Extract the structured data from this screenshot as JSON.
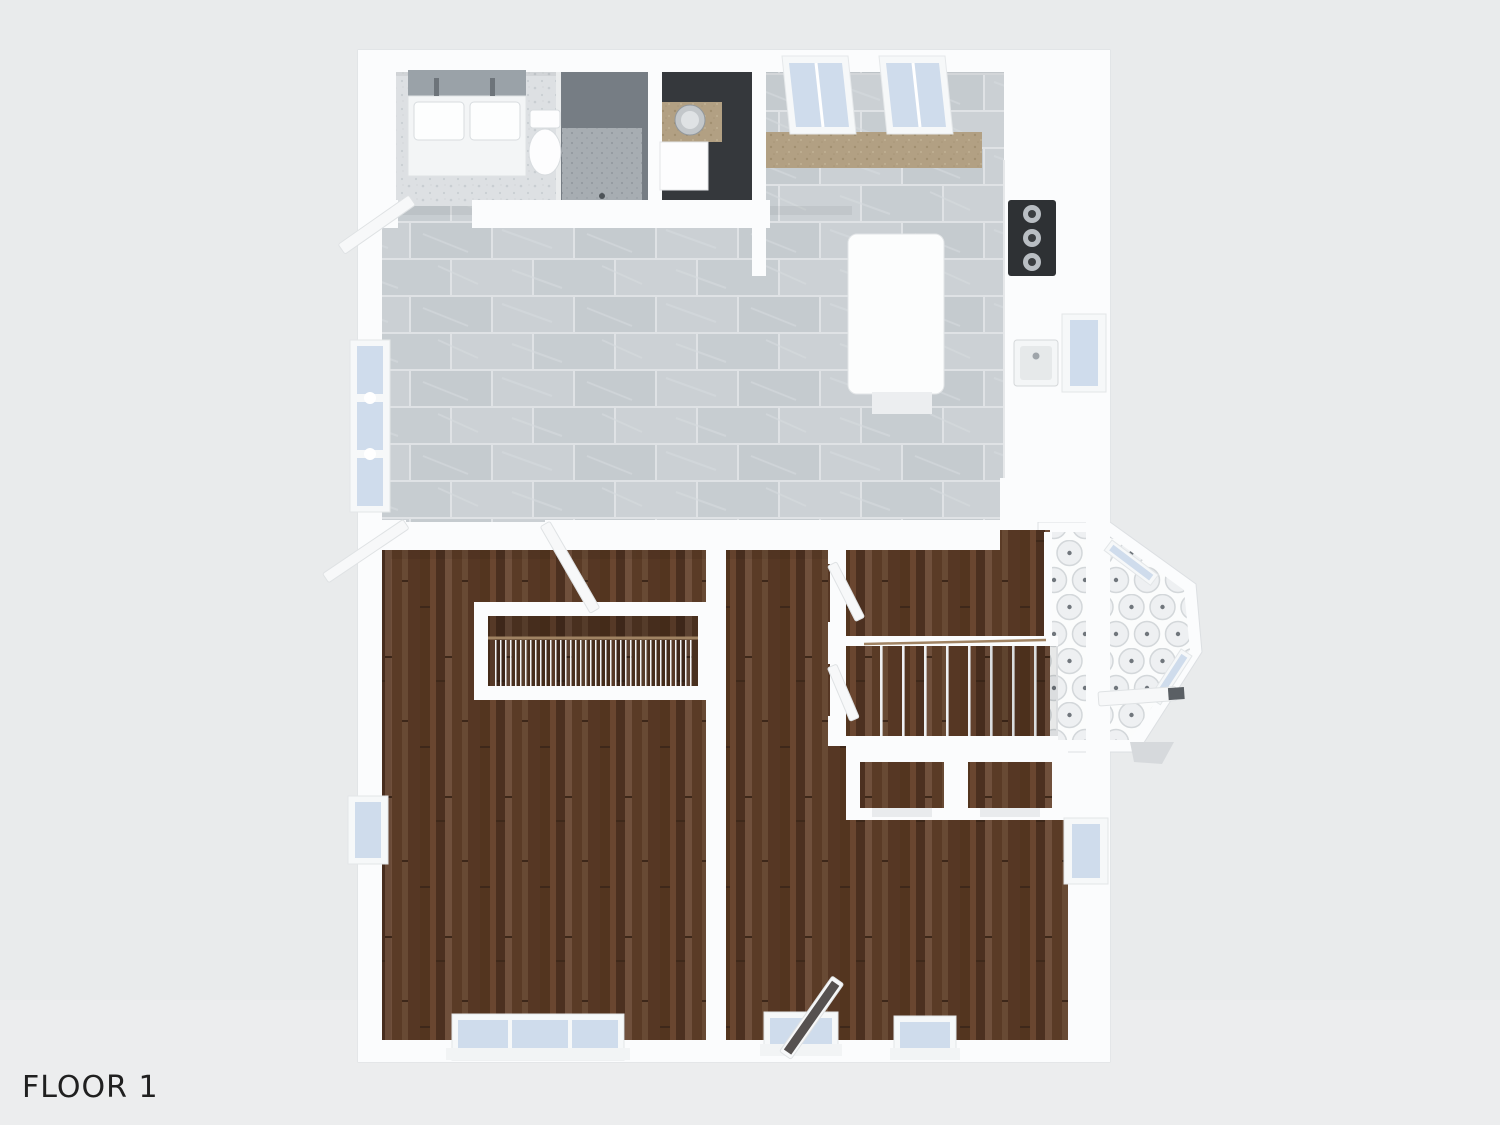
{
  "page": {
    "floor_label": "FLOOR 1"
  },
  "colors": {
    "background": "#e9ebec",
    "wall": "#fbfcfd",
    "wood_base": "#5f3f2a",
    "wood_dark": "#4c3020",
    "wood_mid": "#6a4630",
    "wood_light": "#70503c",
    "tile_base": "#cbd0d4",
    "tile_alt": "#c5cbcf",
    "tile_grout": "#dfe2e5",
    "bath_tile": "#dde0e3",
    "bath_speck": "#c9ced2",
    "shower_dark": "#767d84",
    "shower_light": "#a7adb2",
    "laundry_floor": "#35383c",
    "tan_counter": "#b2a083",
    "tan_speck": "#a18f70",
    "glass": "#cfdcec",
    "window_frame": "#f6f8f9",
    "penny_base": "#fbfcfc",
    "penny_circle": "#eef0f2",
    "penny_ring": "#d3d7da",
    "penny_dot": "#70767c",
    "island": "#fcfdfd",
    "appliance_dark": "#2e3134",
    "metal": "#b9bec3",
    "metal_dark": "#3a3d40",
    "handrail": "#a08363",
    "baluster": "#f4f5f6",
    "door_leaf": "#f7f8f9",
    "door_edge": "#dfe2e4",
    "patio_glass": "#565150",
    "front_door_dark": "#5a5f64",
    "sill": "#f2f4f5",
    "text": "#202020"
  }
}
